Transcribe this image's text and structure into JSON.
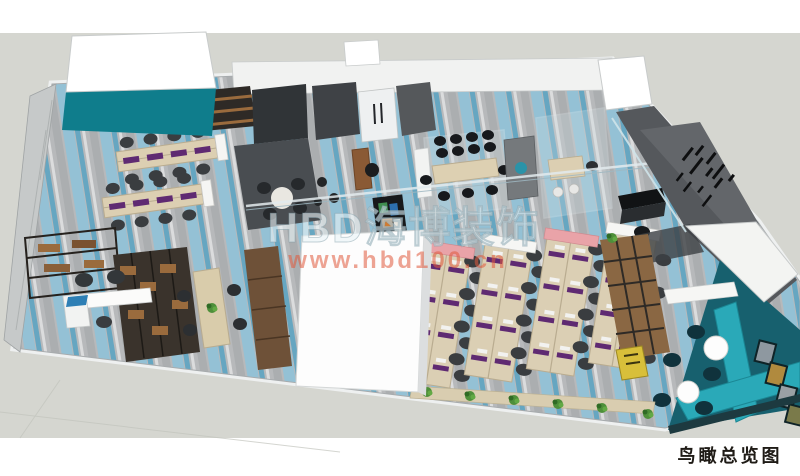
{
  "watermark": {
    "brand": "HBD海博装饰",
    "url": "www.hbd100.cn"
  },
  "caption": {
    "text": "鸟瞰总览图"
  },
  "colors": {
    "brand_teal": "#0f7d8c",
    "lounge_bench_teal": "#2aa9b8",
    "lounge_wall_teal": "#17606e",
    "floor_grey": "#b7b9bb",
    "stripe_blue": "#8ec2da",
    "stripe_teal": "#4aa0c2",
    "ground_grey": "#d5d6d0",
    "desk_beige": "#dbcfb4",
    "accent_purple": "#5f2a72",
    "wood_brown": "#8a6743",
    "dark_room_grey": "#45494d",
    "watermark_url_orange": "#e05a3c",
    "caption_dark": "#1f1b16"
  }
}
